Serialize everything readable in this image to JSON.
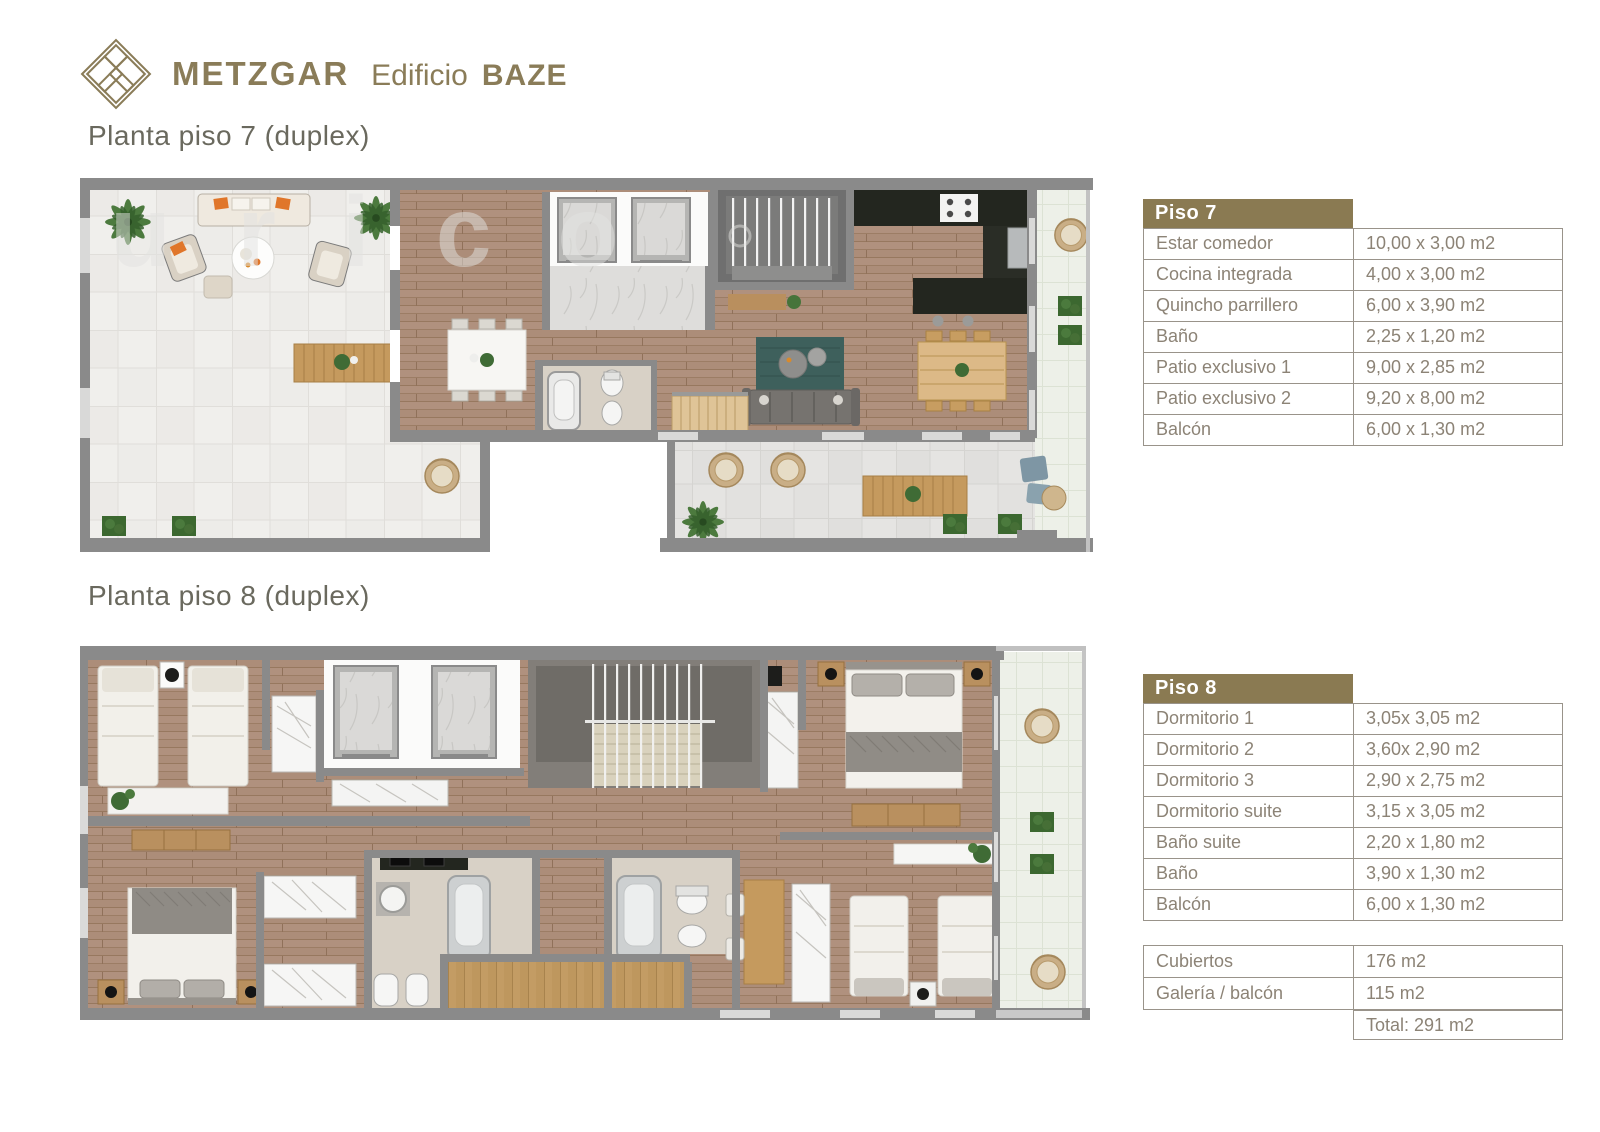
{
  "brand": {
    "name": "METZGAR",
    "building_prefix": "Edificio",
    "building_name": "BAZE"
  },
  "headings": {
    "plan7": "Planta piso 7 (duplex)",
    "plan8": "Planta piso 8 (duplex)"
  },
  "watermark": {
    "text": "urico"
  },
  "piso7_table": {
    "title": "Piso 7",
    "rows": [
      {
        "label": "Estar comedor",
        "value": "10,00 x 3,00 m2"
      },
      {
        "label": "Cocina integrada",
        "value": "4,00 x 3,00 m2"
      },
      {
        "label": "Quincho parrillero",
        "value": "6,00 x 3,90 m2"
      },
      {
        "label": "Baño",
        "value": "2,25 x 1,20 m2"
      },
      {
        "label": "Patio exclusivo 1",
        "value": "9,00 x  2,85 m2"
      },
      {
        "label": "Patio exclusivo 2",
        "value": "9,20 x 8,00 m2"
      },
      {
        "label": "Balcón",
        "value": "6,00 x 1,30 m2"
      }
    ]
  },
  "piso8_table": {
    "title": "Piso 8",
    "rows": [
      {
        "label": "Dormitorio 1",
        "value": "3,05x 3,05 m2"
      },
      {
        "label": "Dormitorio 2",
        "value": "3,60x 2,90 m2"
      },
      {
        "label": "Dormitorio 3",
        "value": "2,90 x 2,75 m2"
      },
      {
        "label": "Dormitorio suite",
        "value": "3,15 x 3,05 m2"
      },
      {
        "label": "Baño suite",
        "value": "2,20 x 1,80 m2"
      },
      {
        "label": "Baño",
        "value": "3,90 x 1,30 m2"
      },
      {
        "label": "Balcón",
        "value": "6,00 x 1,30 m2"
      }
    ]
  },
  "summary_table": {
    "rows": [
      {
        "label": "Cubiertos",
        "value": "176 m2"
      },
      {
        "label": "Galería / balcón",
        "value": "115 m2"
      }
    ],
    "total_label": "Total: 291 m2"
  },
  "colors": {
    "brand_olive": "#8a7a52",
    "wall_gray": "#8a8a8a",
    "wood_floor": "#ac8d79",
    "table_text": "#8c8376"
  }
}
